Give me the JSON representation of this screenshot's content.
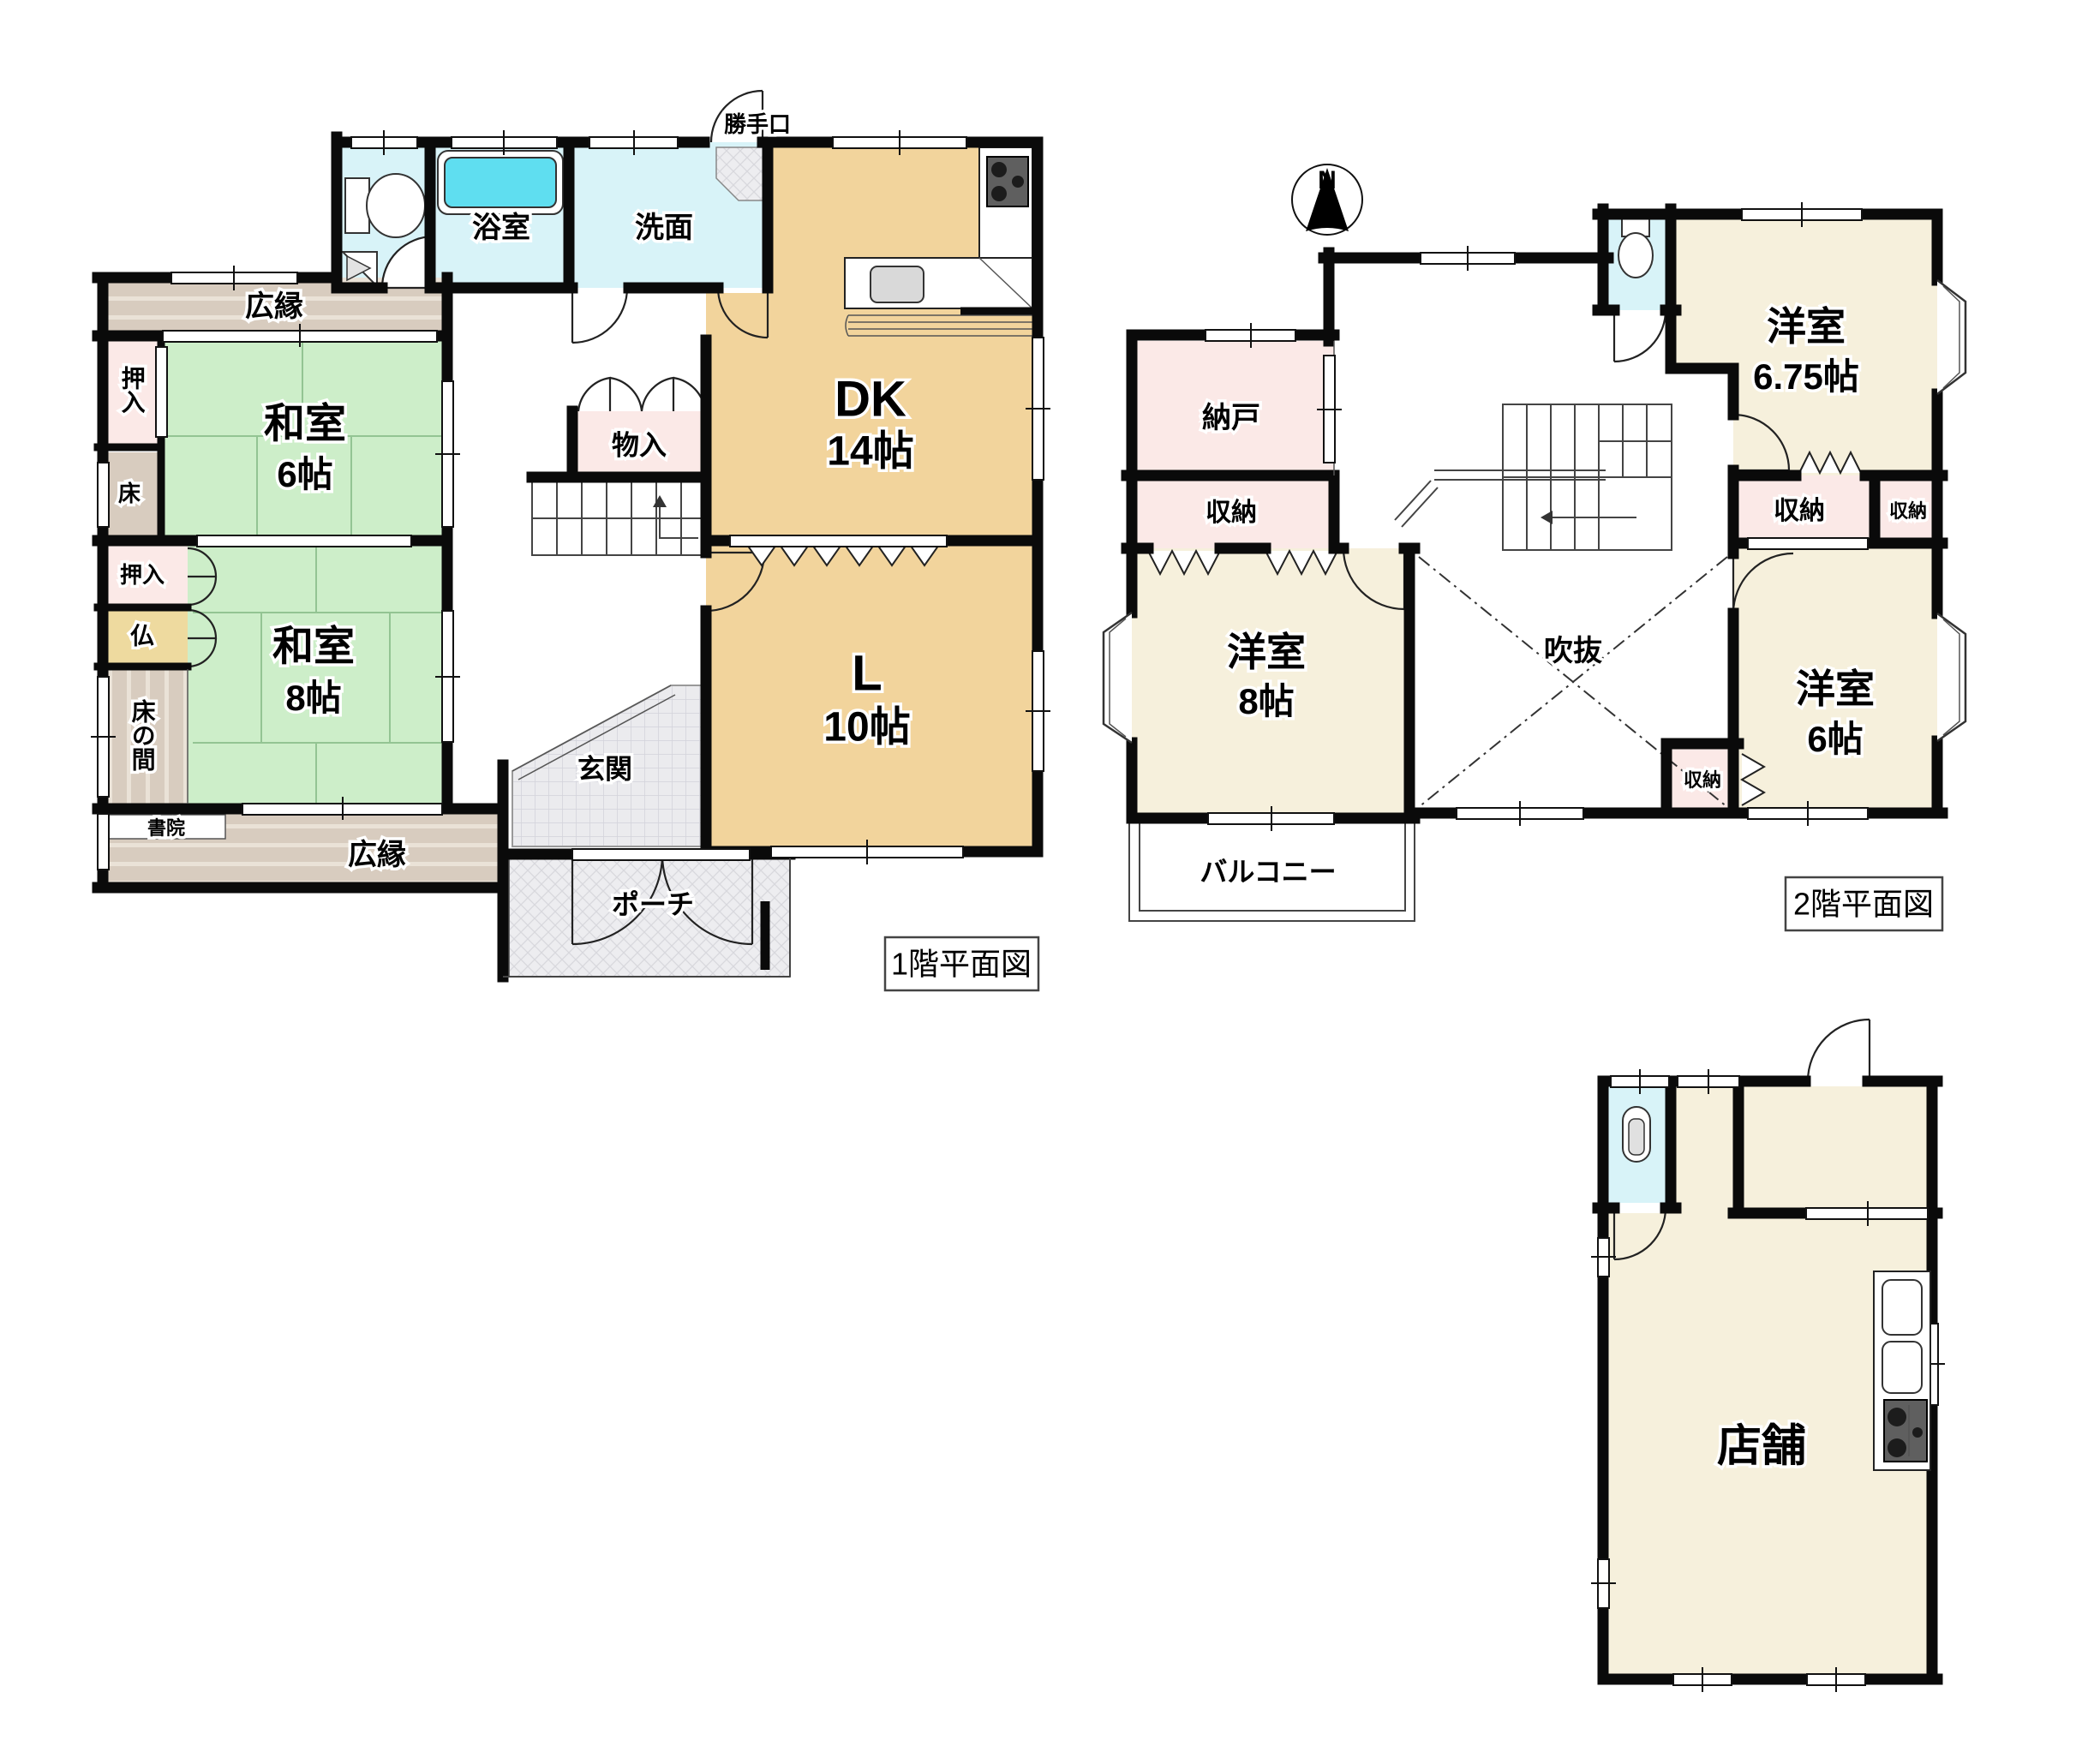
{
  "document_type": "japanese-floor-plan",
  "colors": {
    "wall": "#0a0a0a",
    "tatami_green": "#cdeec9",
    "dk_living_tan": "#f2d49c",
    "western_cream": "#f6f0dc",
    "closet_pink": "#fbe9e7",
    "water_cyan": "#d8f3f8",
    "bathtub_cyan": "#5fdef0",
    "veranda_taupe": "#d8ccbf",
    "altar_tan": "#eeda9f",
    "tile_gray": "#ebebee",
    "fixture_dark": "#5f5f5f"
  },
  "floor1": {
    "title": "1階平面図",
    "rooms": {
      "katteguchi": "勝手口",
      "yokushitsu": "浴室",
      "senmen": "洗面",
      "dk": {
        "name": "DK",
        "size": "14帖"
      },
      "hiroen_top": "広縁",
      "oshiire_top": "押入",
      "washitsu6": {
        "name": "和室",
        "size": "6帖"
      },
      "toko": "床",
      "monoire": "物入",
      "oshiire_mid": "押入",
      "butsu": "仏",
      "tokonoma": "床の間",
      "washitsu8": {
        "name": "和室",
        "size": "8帖"
      },
      "shoin": "書院",
      "hiroen_bottom": "広縁",
      "genkan": "玄関",
      "porch": "ポーチ",
      "living": {
        "name": "L",
        "size": "10帖"
      }
    }
  },
  "floor2": {
    "title": "2階平面図",
    "compass_north": "N",
    "rooms": {
      "nando": "納戸",
      "shuno_left": "収納",
      "yoshitsu8": {
        "name": "洋室",
        "size": "8帖"
      },
      "balcony": "バルコニー",
      "fukinuke": "吹抜",
      "yoshitsu675": {
        "name": "洋室",
        "size": "6.75帖"
      },
      "shuno_wide": "収納",
      "shuno_small": "収納",
      "yoshitsu6": {
        "name": "洋室",
        "size": "6帖"
      },
      "shuno_bottom": "収納"
    }
  },
  "store": {
    "rooms": {
      "tenpo": "店舗"
    }
  }
}
